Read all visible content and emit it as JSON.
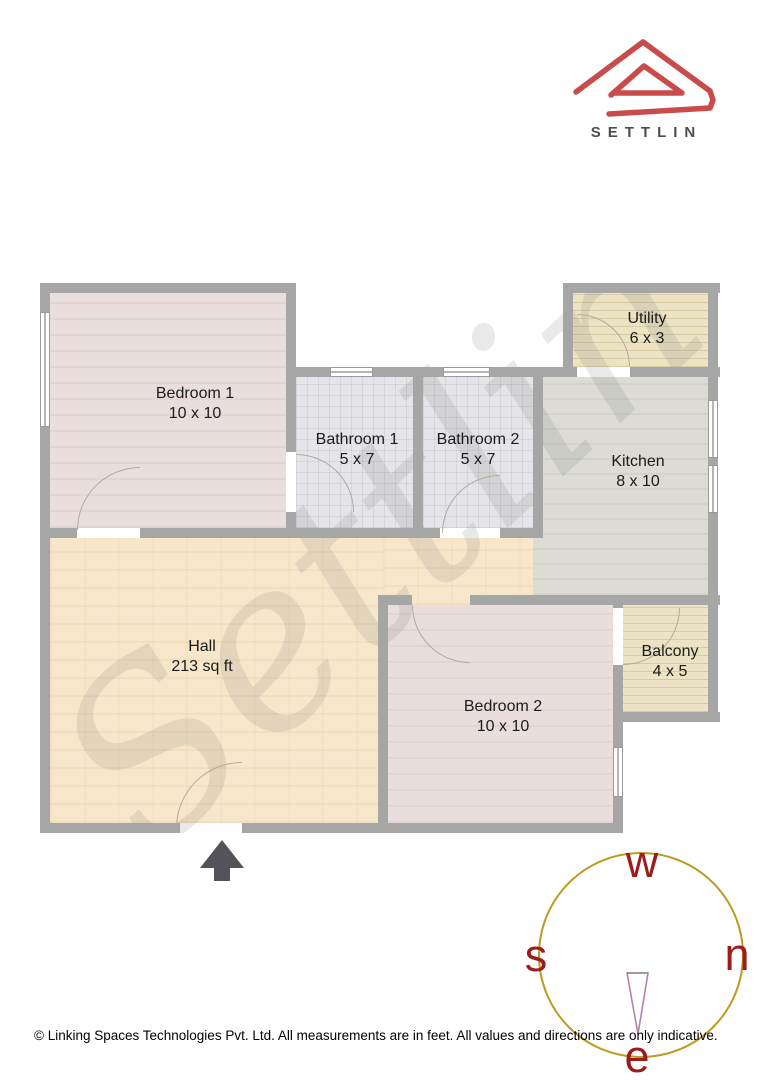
{
  "brand": {
    "logo_text": "SETTLIN"
  },
  "watermark": "Settlin",
  "rooms": [
    {
      "id": "bedroom1",
      "name": "Bedroom 1",
      "dims": "10 x 10"
    },
    {
      "id": "bathroom1",
      "name": "Bathroom 1",
      "dims": "5 x 7"
    },
    {
      "id": "bathroom2",
      "name": "Bathroom 2",
      "dims": "5 x 7"
    },
    {
      "id": "utility",
      "name": "Utility",
      "dims": "6 x 3"
    },
    {
      "id": "kitchen",
      "name": "Kitchen",
      "dims": "8 x 10"
    },
    {
      "id": "hall",
      "name": "Hall",
      "dims": "213 sq ft"
    },
    {
      "id": "bedroom2",
      "name": "Bedroom 2",
      "dims": "10 x 10"
    },
    {
      "id": "balcony",
      "name": "Balcony",
      "dims": "4 x 5"
    }
  ],
  "compass": {
    "top": "w",
    "right": "n",
    "left": "s",
    "bottom": "e"
  },
  "footer": "© Linking Spaces Technologies Pvt. Ltd. All measurements are in feet. All values and directions are only indicative.",
  "colors": {
    "logo_red": "#c94b4b",
    "wall_gray": "#a6a6a6",
    "compass_ring": "#bf9b25",
    "compass_letter": "#9c1b1b",
    "needle_outline": "#b283a5",
    "hall_floor": "#f7e7ca",
    "bedroom_floor": "#e9dedd",
    "bathroom_floor": "#e5e5e9",
    "kitchen_floor": "#dcdcd4",
    "utility_floor": "#ece3c4"
  }
}
